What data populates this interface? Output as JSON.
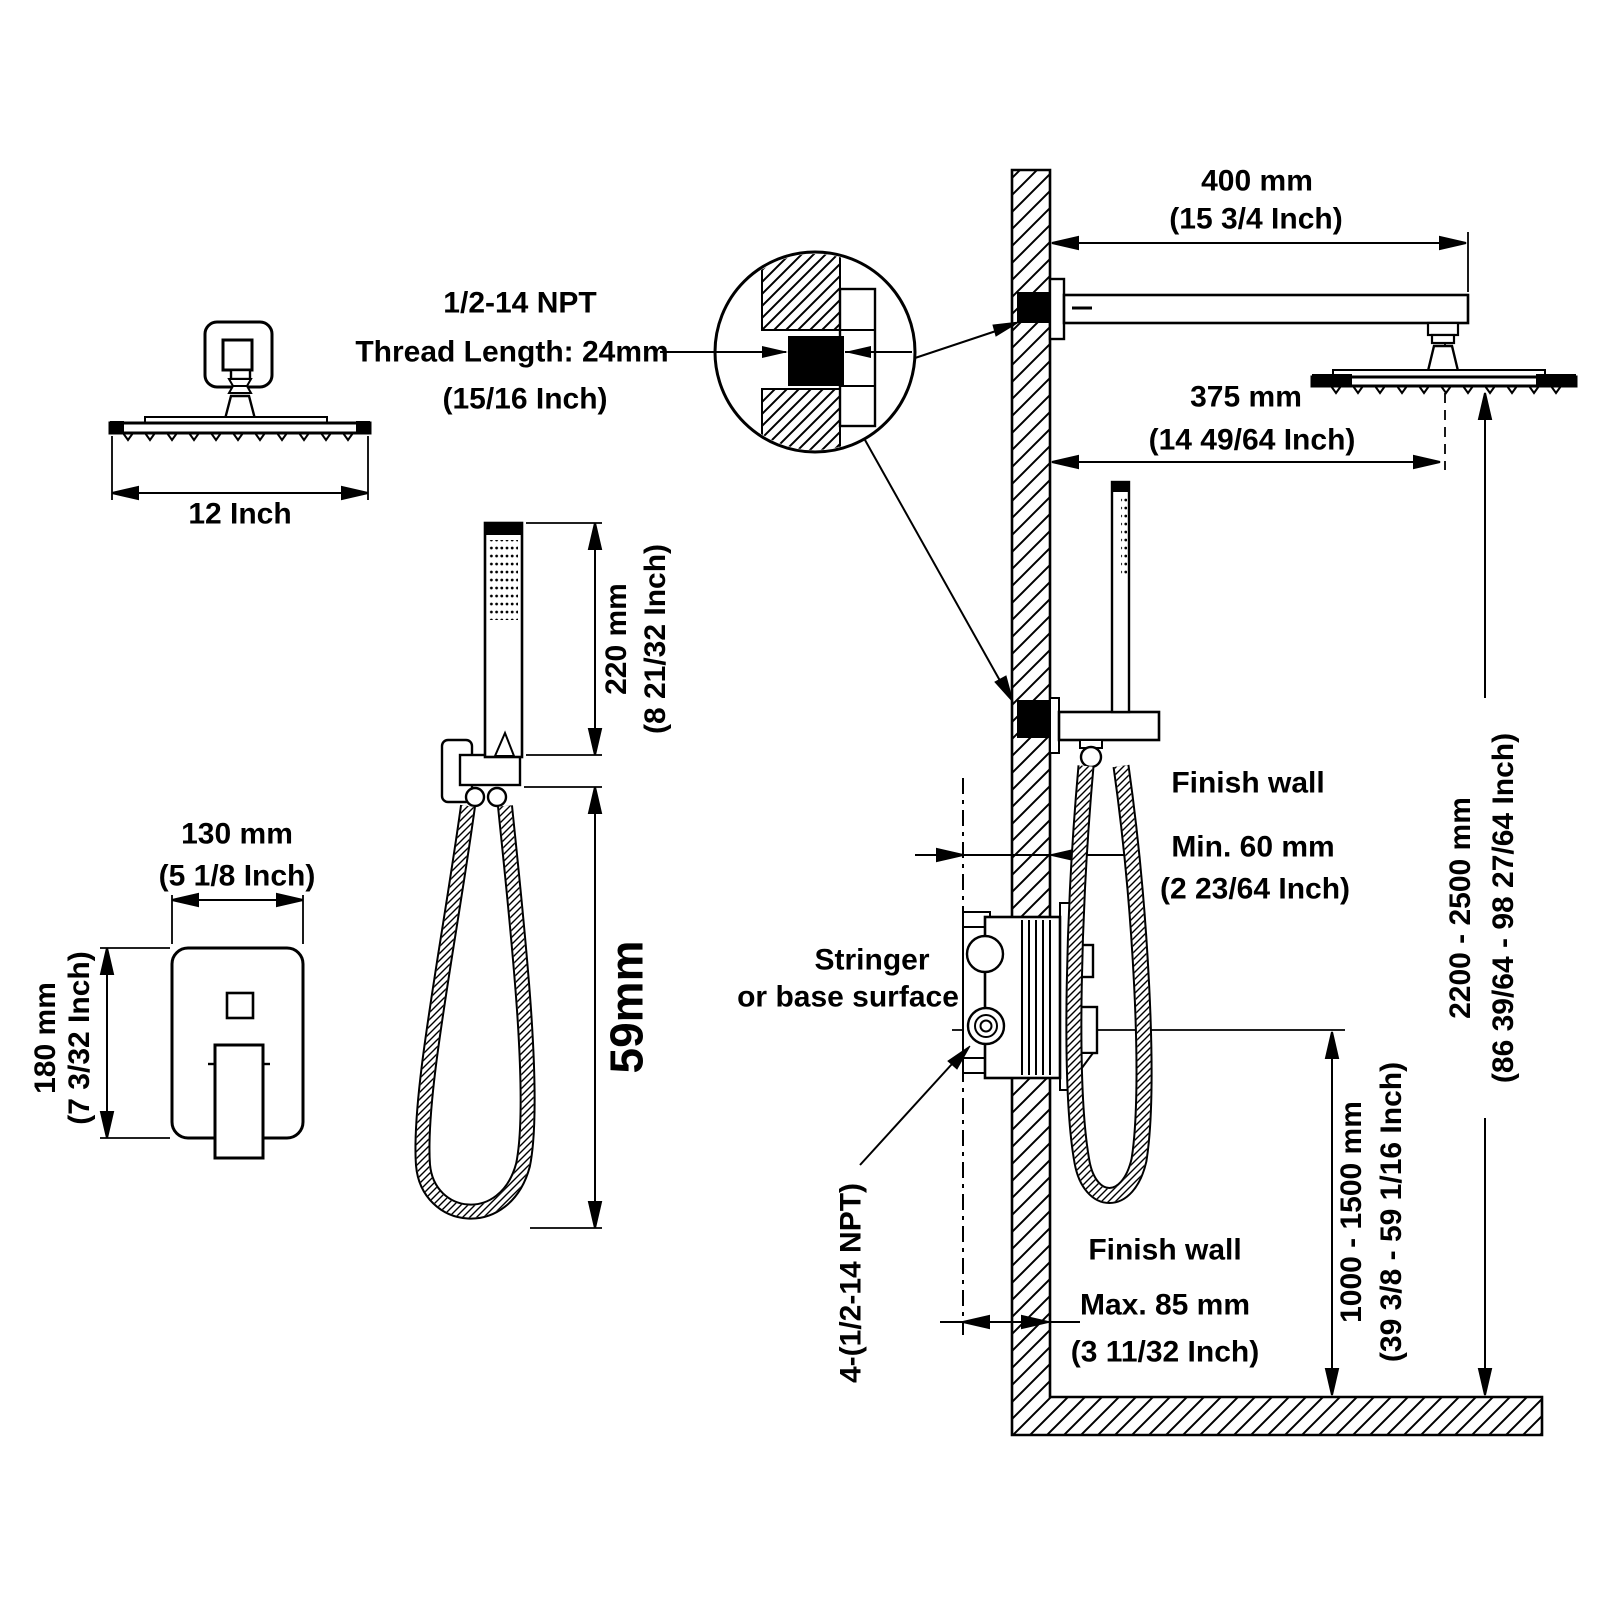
{
  "drawing": {
    "overhead_view": {
      "width_label": "12 Inch"
    },
    "thread_note": {
      "line1": "1/2-14 NPT",
      "line2": "Thread Length: 24mm",
      "line3": "(15/16 Inch)"
    },
    "arm_length": {
      "mm": "400 mm",
      "inch": "(15 3/4 Inch)"
    },
    "head_offset": {
      "mm": "375 mm",
      "inch": "(14 49/64 Inch)"
    },
    "handshower": {
      "wand_mm": "220 mm",
      "wand_inch": "(8 21/32 Inch)",
      "hose_label": "59mm"
    },
    "valve_trim": {
      "width_mm": "130 mm",
      "width_inch": "(5 1/8 Inch)",
      "height_mm": "180 mm",
      "height_inch": "(7 3/32 Inch)"
    },
    "finish_wall_upper": {
      "title": "Finish wall",
      "mm": "Min. 60 mm",
      "inch": "(2 23/64 Inch)"
    },
    "stringer": {
      "line1": "Stringer",
      "line2": "or base surface"
    },
    "mount_height": {
      "mm": "2200 - 2500 mm",
      "inch": "(86 39/64 - 98 27/64 Inch)"
    },
    "valve_height": {
      "mm": "1000 - 1500 mm",
      "inch": "(39 3/8 - 59 1/16 Inch)"
    },
    "finish_wall_lower": {
      "title": "Finish wall",
      "mm": "Max. 85 mm",
      "inch": "(3 11/32 Inch)"
    },
    "ports_label": "4-(1/2-14 NPT)"
  },
  "colors": {
    "ink": "#000000",
    "paper": "#ffffff"
  }
}
